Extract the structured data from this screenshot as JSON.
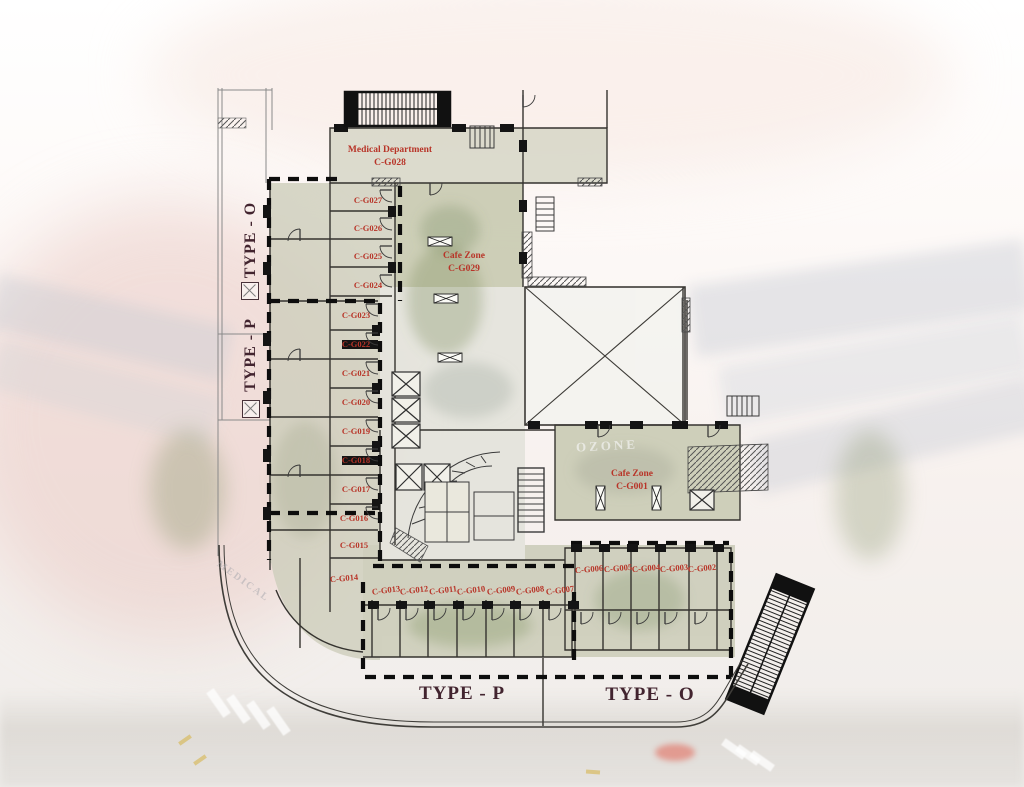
{
  "areas": {
    "medical": {
      "name": "Medical Department",
      "code": "C-G028"
    },
    "cafe_top": {
      "name": "Cafe Zone",
      "code": "C-G029"
    },
    "cafe_right": {
      "name": "Cafe Zone",
      "code": "C-G001"
    }
  },
  "zone_labels": {
    "left_vertical_top": "TYPE - O",
    "left_vertical_mid": "TYPE - P",
    "bottom_left": "TYPE - P",
    "bottom_right": "TYPE - O"
  },
  "units": [
    {
      "code": "C-G027"
    },
    {
      "code": "C-G026"
    },
    {
      "code": "C-G025"
    },
    {
      "code": "C-G024"
    },
    {
      "code": "C-G023"
    },
    {
      "code": "C-G022"
    },
    {
      "code": "C-G021"
    },
    {
      "code": "C-G020"
    },
    {
      "code": "C-G019"
    },
    {
      "code": "C-G018"
    },
    {
      "code": "C-G017"
    },
    {
      "code": "C-G016"
    },
    {
      "code": "C-G015"
    },
    {
      "code": "C-G014"
    },
    {
      "code": "C-G013"
    },
    {
      "code": "C-G012"
    },
    {
      "code": "C-G011"
    },
    {
      "code": "C-G010"
    },
    {
      "code": "C-G009"
    },
    {
      "code": "C-G008"
    },
    {
      "code": "C-G007"
    },
    {
      "code": "C-G006"
    },
    {
      "code": "C-G005"
    },
    {
      "code": "C-G004"
    },
    {
      "code": "C-G003"
    },
    {
      "code": "C-G002"
    }
  ],
  "background": {
    "watermarks": {
      "building_sign": "OZONE",
      "facade_sign": "MEDICAL"
    }
  },
  "colors": {
    "unit_label": "#b83428",
    "zone_label": "#42242f",
    "plan_fill": "#cfcfbd",
    "dashed_boundary": "#0d0d0d"
  }
}
